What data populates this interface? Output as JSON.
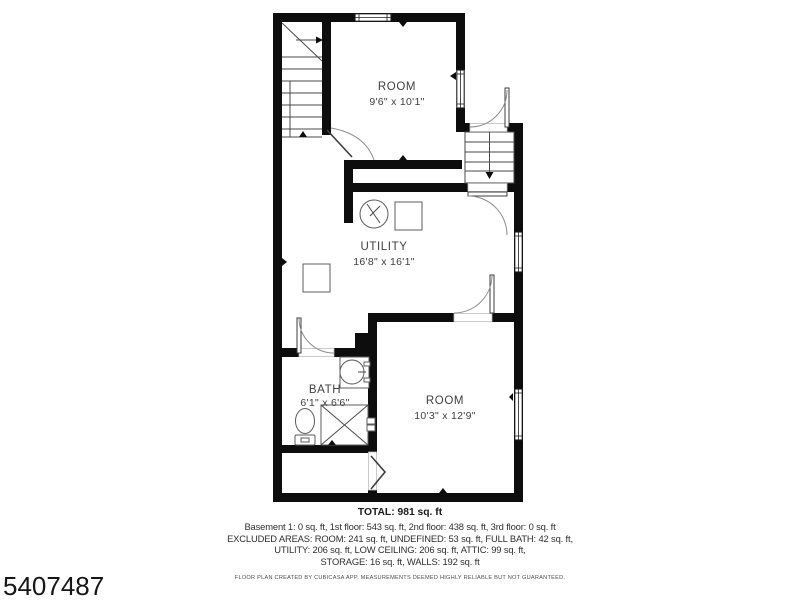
{
  "meta": {
    "image_number": "5407487"
  },
  "floorplan": {
    "rooms": [
      {
        "name": "ROOM",
        "dims": "9'6\" x 10'1\""
      },
      {
        "name": "UTILITY",
        "dims": "16'8\" x 16'1\""
      },
      {
        "name": "BATH",
        "dims": "6'1\" x 6'6\""
      },
      {
        "name": "ROOM",
        "dims": "10'3\" x 12'9\""
      }
    ],
    "fixtures": [
      "stairs-up-icon",
      "stairs-down-icon",
      "water-heater-icon",
      "appliance-icon",
      "appliance-icon",
      "sink-icon",
      "toilet-icon",
      "shower-icon",
      "door-arc-icon",
      "window-icon",
      "open-doorway-icon"
    ],
    "colors": {
      "wall": "#0d0d0d",
      "label": "#3f3f3f",
      "fixture": "#5c5c5c",
      "background": "#ffffff"
    }
  },
  "summary": {
    "total": "TOTAL: 981 sq. ft",
    "lines": [
      "Basement 1: 0 sq. ft, 1st floor: 543 sq. ft, 2nd floor: 438 sq. ft, 3rd floor: 0 sq. ft",
      "EXCLUDED AREAS: ROOM: 241 sq. ft, UNDEFINED: 53 sq. ft, FULL BATH: 42 sq. ft,",
      "UTILITY: 206 sq. ft, LOW CEILING: 206 sq. ft, ATTIC: 99 sq. ft,",
      "STORAGE: 16 sq. ft, WALLS: 192 sq. ft"
    ],
    "disclaimer": "FLOOR PLAN CREATED BY CUBICASA APP, MEASUREMENTS DEEMED HIGHLY RELIABLE BUT NOT GUARANTEED."
  }
}
